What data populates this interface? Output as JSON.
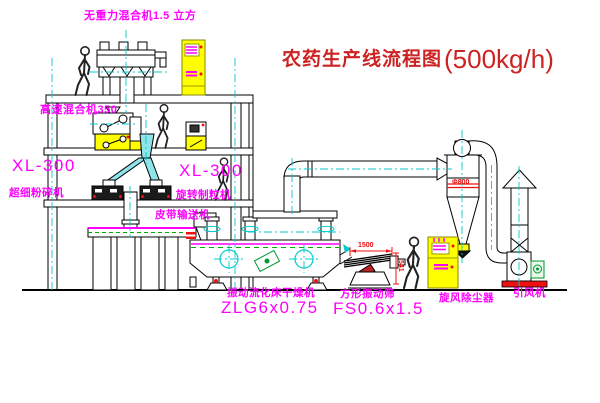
{
  "title": {
    "name": "农药生产线流程图",
    "capacity": "(500kg/h)"
  },
  "labels": {
    "gravity_mixer": "无重力混合机1.5 立方",
    "high_speed_mixer": "高速混合机350",
    "pulverizer_model": "XL-300",
    "pulverizer_name": "超细粉碎机",
    "granulator_model": "XL-300",
    "granulator_name": "旋转制粒机",
    "belt_conveyor": "皮带输送机",
    "dryer_name": "振动流化床干燥机",
    "dryer_model": "ZLG6x0.75",
    "sieve_name": "方形振动筛",
    "sieve_model": "FS0.6x1.5",
    "cyclone_name": "旋风除尘器",
    "fan_name": "引风机"
  },
  "dimensions": {
    "sieve_length": "1500",
    "sieve_outlet_height": "541",
    "cyclone_diameter": "Φ800"
  },
  "colors": {
    "label_magenta": "#ff00ff",
    "title_red": "#cc2222",
    "centerline_cyan": "#00cccc",
    "cabinet_yellow": "#ffff00",
    "accent_red": "#ee1111",
    "motor_green": "#009933"
  }
}
